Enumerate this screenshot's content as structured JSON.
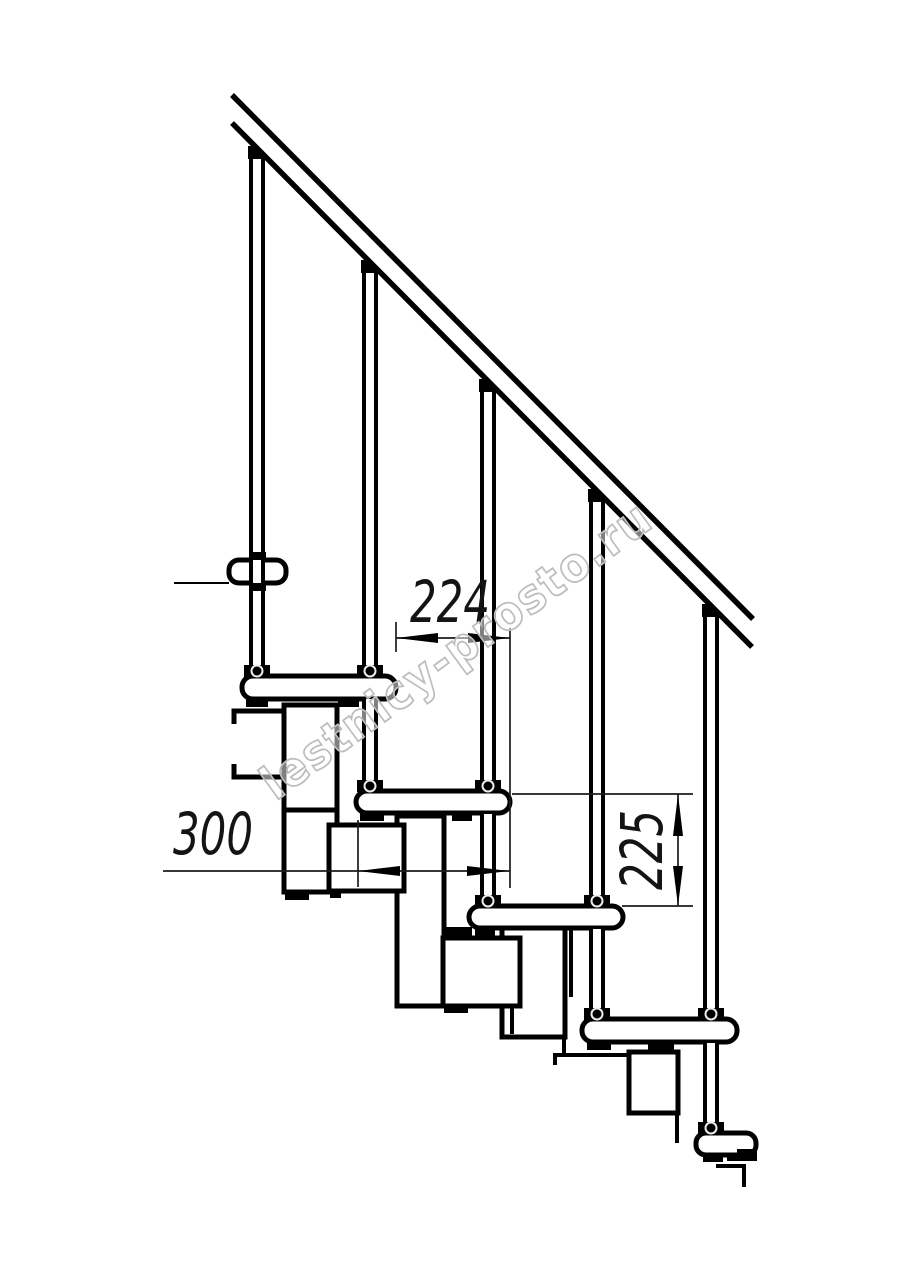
{
  "canvas": {
    "width": 914,
    "height": 1280,
    "background": "#ffffff"
  },
  "watermark": {
    "text": "lestnicy-prosto.ru",
    "color": "#bdbdbd"
  },
  "dimensions": {
    "step_run": "224",
    "tread_depth": "300",
    "riser_height": "225"
  },
  "drawing": {
    "ink": "#000000",
    "thin_ink": "#1c1c1c",
    "shapes": [
      {
        "t": "rect",
        "n": "module-box-right-3",
        "x": 397,
        "y": 816,
        "w": 47,
        "h": 190,
        "cls": "tf"
      },
      {
        "t": "rect",
        "n": "module-box-right-4",
        "x": 502,
        "y": 928,
        "w": 63,
        "h": 109,
        "cls": "tf"
      },
      {
        "t": "rect",
        "n": "module-box-2",
        "x": 284,
        "y": 705,
        "w": 53,
        "h": 187,
        "cls": "tf"
      },
      {
        "t": "line",
        "n": "module-divider",
        "x1": 284,
        "y1": 810,
        "x2": 337,
        "y2": 810,
        "cls": "t5"
      },
      {
        "t": "rect",
        "n": "module-box-3",
        "x": 329,
        "y": 825,
        "w": 75,
        "h": 66,
        "cls": "tf"
      },
      {
        "t": "rect",
        "n": "module-box-4",
        "x": 443,
        "y": 938,
        "w": 77,
        "h": 68,
        "cls": "tf"
      },
      {
        "t": "rect",
        "n": "module-box-5",
        "x": 629,
        "y": 1052,
        "w": 49,
        "h": 61,
        "cls": "tf"
      },
      {
        "t": "rect",
        "n": "module-nub",
        "x": 285,
        "y": 892,
        "w": 24,
        "h": 8,
        "cls": "blk"
      },
      {
        "t": "rect",
        "n": "module-nub",
        "x": 330,
        "y": 891,
        "w": 11,
        "h": 7,
        "cls": "blk"
      },
      {
        "t": "rect",
        "n": "module-nub",
        "x": 444,
        "y": 1006,
        "w": 24,
        "h": 7,
        "cls": "blk"
      },
      {
        "t": "line",
        "n": "module-edge",
        "x1": 512,
        "y1": 1006,
        "x2": 512,
        "y2": 1034,
        "cls": "t4"
      },
      {
        "t": "line",
        "n": "module-edge",
        "x1": 571,
        "y1": 928,
        "x2": 571,
        "y2": 997,
        "cls": "t4"
      },
      {
        "t": "line",
        "n": "module-edge",
        "x1": 564,
        "y1": 1037,
        "x2": 564,
        "y2": 1055,
        "cls": "t4"
      },
      {
        "t": "polyline",
        "n": "break-line",
        "pts": "555,1065 555,1055 630,1055",
        "cls": "t4"
      },
      {
        "t": "line",
        "n": "module-edge",
        "x1": 677,
        "y1": 1113,
        "x2": 677,
        "y2": 1143,
        "cls": "t4"
      },
      {
        "t": "polyline",
        "n": "floor-bracket",
        "pts": "234,724 234,711 285,711",
        "cls": "t5"
      },
      {
        "t": "polyline",
        "n": "floor-bracket",
        "pts": "234,764 234,777 285,777",
        "cls": "t5"
      },
      {
        "t": "line",
        "n": "upper-floor-line",
        "x1": 174,
        "y1": 583,
        "x2": 229,
        "y2": 583,
        "cls": "t2"
      },
      {
        "t": "rrect",
        "n": "tread-2",
        "x": 242,
        "y": 676,
        "w": 154,
        "h": 23,
        "r": 11,
        "cls": "tf"
      },
      {
        "t": "rrect",
        "n": "tread-3",
        "x": 356,
        "y": 791,
        "w": 154,
        "h": 22,
        "r": 11,
        "cls": "tf"
      },
      {
        "t": "rrect",
        "n": "tread-4",
        "x": 469,
        "y": 906,
        "w": 154,
        "h": 22,
        "r": 11,
        "cls": "tf"
      },
      {
        "t": "rrect",
        "n": "tread-5",
        "x": 582,
        "y": 1019,
        "w": 155,
        "h": 23,
        "r": 11,
        "cls": "tf"
      },
      {
        "t": "rrect",
        "n": "upper-floor-tread",
        "x": 229,
        "y": 560,
        "w": 57,
        "h": 23,
        "r": 10,
        "cls": "tf"
      },
      {
        "t": "rrect",
        "n": "lower-floor-tread",
        "x": 696,
        "y": 1133,
        "w": 60,
        "h": 22,
        "r": 10,
        "cls": "tf"
      },
      {
        "t": "vtube",
        "n": "baluster-1",
        "x": 257,
        "y1": 155,
        "y2": 677
      },
      {
        "t": "vtube",
        "n": "baluster-2",
        "x": 370,
        "y1": 269,
        "y2": 677
      },
      {
        "t": "vtube",
        "n": "baluster-3",
        "x": 488,
        "y1": 388,
        "y2": 792
      },
      {
        "t": "vtube",
        "n": "baluster-4",
        "x": 597,
        "y1": 498,
        "y2": 907
      },
      {
        "t": "vtube",
        "n": "baluster-5",
        "x": 711,
        "y1": 613,
        "y2": 1020
      },
      {
        "t": "vtube",
        "n": "support-tube-2",
        "x": 370,
        "y1": 699,
        "y2": 792
      },
      {
        "t": "vtube",
        "n": "support-tube-3",
        "x": 488,
        "y1": 814,
        "y2": 907
      },
      {
        "t": "vtube",
        "n": "support-tube-4",
        "x": 597,
        "y1": 929,
        "y2": 1020
      },
      {
        "t": "vtube",
        "n": "support-tube-5",
        "x": 711,
        "y1": 1043,
        "y2": 1134
      },
      {
        "t": "rect",
        "n": "tread-clamp",
        "x": 246,
        "y": 698,
        "w": 22,
        "h": 9,
        "cls": "blk"
      },
      {
        "t": "rect",
        "n": "tread-clamp",
        "x": 338,
        "y": 698,
        "w": 21,
        "h": 9,
        "cls": "blk"
      },
      {
        "t": "rect",
        "n": "tread-clamp",
        "x": 360,
        "y": 812,
        "w": 24,
        "h": 9,
        "cls": "blk"
      },
      {
        "t": "rect",
        "n": "tread-clamp",
        "x": 452,
        "y": 812,
        "w": 20,
        "h": 9,
        "cls": "blk"
      },
      {
        "t": "rect",
        "n": "tread-clamp",
        "x": 446,
        "y": 927,
        "w": 26,
        "h": 9,
        "cls": "blk"
      },
      {
        "t": "rect",
        "n": "tread-clamp",
        "x": 475,
        "y": 927,
        "w": 20,
        "h": 9,
        "cls": "blk"
      },
      {
        "t": "rect",
        "n": "tread-clamp",
        "x": 587,
        "y": 1041,
        "w": 24,
        "h": 9,
        "cls": "blk"
      },
      {
        "t": "rect",
        "n": "tread-clamp",
        "x": 648,
        "y": 1041,
        "w": 26,
        "h": 9,
        "cls": "blk"
      },
      {
        "t": "rect",
        "n": "tread-clamp",
        "x": 249,
        "y": 552,
        "w": 17,
        "h": 8,
        "cls": "blk"
      },
      {
        "t": "rect",
        "n": "tread-clamp",
        "x": 250,
        "y": 583,
        "w": 16,
        "h": 8,
        "cls": "blk"
      },
      {
        "t": "rect",
        "n": "tread-clamp",
        "x": 703,
        "y": 1154,
        "w": 20,
        "h": 8,
        "cls": "blk"
      },
      {
        "t": "rect",
        "n": "tread-clamp",
        "x": 727,
        "y": 1154,
        "w": 10,
        "h": 7,
        "cls": "blk"
      },
      {
        "t": "rect",
        "n": "floor-anchor",
        "x": 737,
        "y": 1149,
        "w": 20,
        "h": 12,
        "cls": "blk"
      },
      {
        "t": "polyline",
        "n": "break-line",
        "pts": "716,1166 744,1166 744,1187",
        "cls": "t4"
      },
      {
        "t": "conn",
        "n": "handrail-connector",
        "x": 257,
        "y": 146
      },
      {
        "t": "conn",
        "n": "handrail-connector",
        "x": 370,
        "y": 260
      },
      {
        "t": "conn",
        "n": "handrail-connector",
        "x": 488,
        "y": 379
      },
      {
        "t": "conn",
        "n": "handrail-connector",
        "x": 597,
        "y": 489
      },
      {
        "t": "conn",
        "n": "handrail-connector",
        "x": 711,
        "y": 604
      },
      {
        "t": "collar",
        "n": "baluster-collar",
        "x": 257,
        "y": 677
      },
      {
        "t": "collar",
        "n": "baluster-collar",
        "x": 370,
        "y": 677
      },
      {
        "t": "collar",
        "n": "baluster-collar",
        "x": 370,
        "y": 792
      },
      {
        "t": "collar",
        "n": "baluster-collar",
        "x": 488,
        "y": 792
      },
      {
        "t": "collar",
        "n": "baluster-collar",
        "x": 488,
        "y": 907
      },
      {
        "t": "collar",
        "n": "baluster-collar",
        "x": 597,
        "y": 907
      },
      {
        "t": "collar",
        "n": "baluster-collar",
        "x": 597,
        "y": 1020
      },
      {
        "t": "collar",
        "n": "baluster-collar",
        "x": 711,
        "y": 1020
      },
      {
        "t": "collar",
        "n": "baluster-collar",
        "x": 711,
        "y": 1134
      },
      {
        "t": "polygon",
        "n": "handrail-body",
        "pts": "232,93 753,617 752,649 232,125",
        "cls": "wf"
      },
      {
        "t": "line",
        "n": "handrail-top-edge",
        "x1": 232,
        "y1": 95,
        "x2": 753,
        "y2": 619,
        "cls": "t55"
      },
      {
        "t": "line",
        "n": "handrail-bottom-edge",
        "x1": 232,
        "y1": 123,
        "x2": 752,
        "y2": 647,
        "cls": "t55"
      },
      {
        "t": "line",
        "n": "ext-line-224-left",
        "x1": 396,
        "y1": 622,
        "x2": 396,
        "y2": 652,
        "cls": "thin"
      },
      {
        "t": "line",
        "n": "ext-line-shared",
        "x1": 510,
        "y1": 628,
        "x2": 510,
        "y2": 888,
        "cls": "thin"
      },
      {
        "t": "line",
        "n": "dim-line-224",
        "x1": 396,
        "y1": 638,
        "x2": 510,
        "y2": 638,
        "cls": "thin"
      },
      {
        "t": "polygon",
        "n": "arrow-224-left",
        "pts": "396,638 438,633 438,643",
        "cls": "blk"
      },
      {
        "t": "polygon",
        "n": "arrow-224-right",
        "pts": "510,638 468,633 468,643",
        "cls": "blk"
      },
      {
        "t": "line",
        "n": "dim-line-300",
        "x1": 163,
        "y1": 871,
        "x2": 510,
        "y2": 871,
        "cls": "thin"
      },
      {
        "t": "line",
        "n": "ext-line-300-left",
        "x1": 358,
        "y1": 820,
        "x2": 358,
        "y2": 887,
        "cls": "thin"
      },
      {
        "t": "polygon",
        "n": "arrow-300-left",
        "pts": "358,871 400,866 400,876",
        "cls": "blk"
      },
      {
        "t": "polygon",
        "n": "arrow-300-right",
        "pts": "509,871 467,866 467,876",
        "cls": "blk"
      },
      {
        "t": "line",
        "n": "ext-line-225-top",
        "x1": 512,
        "y1": 794,
        "x2": 693,
        "y2": 794,
        "cls": "thin"
      },
      {
        "t": "line",
        "n": "ext-line-225-bottom",
        "x1": 622,
        "y1": 906,
        "x2": 693,
        "y2": 906,
        "cls": "thin"
      },
      {
        "t": "line",
        "n": "dim-line-225",
        "x1": 678,
        "y1": 794,
        "x2": 678,
        "y2": 906,
        "cls": "thin"
      },
      {
        "t": "polygon",
        "n": "arrow-225-top",
        "pts": "678,794 673,836 683,836",
        "cls": "blk"
      },
      {
        "t": "polygon",
        "n": "arrow-225-bottom",
        "pts": "678,906 673,866 683,866",
        "cls": "blk"
      }
    ]
  }
}
